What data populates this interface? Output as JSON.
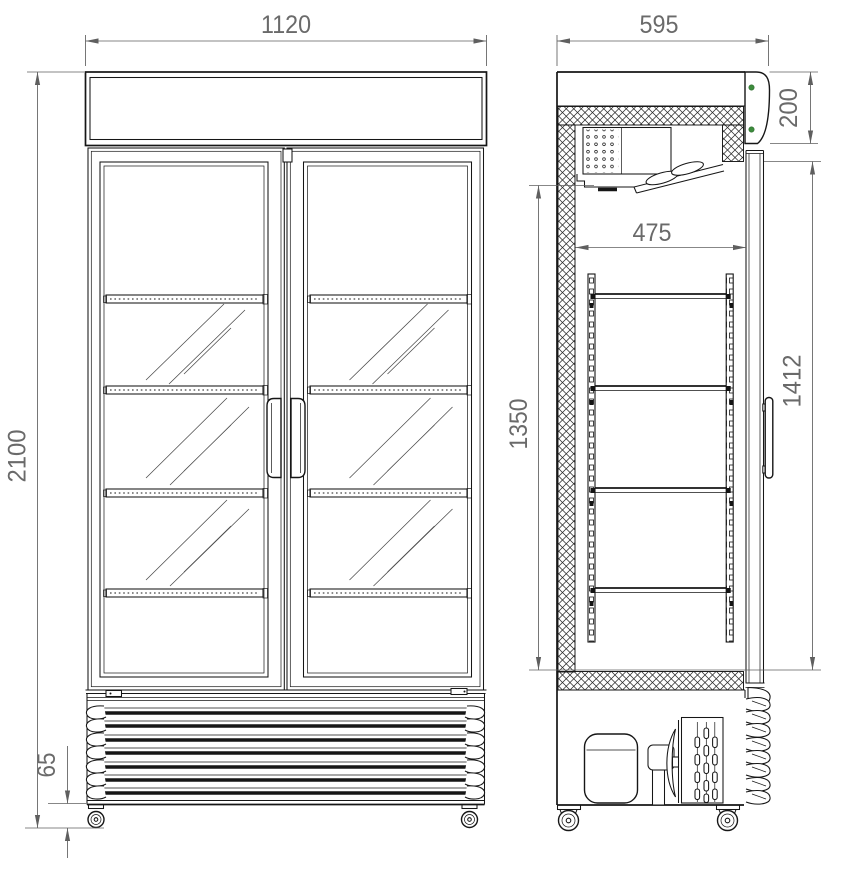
{
  "front_view": {
    "dim_overall_width": "1120",
    "dim_overall_height": "2100",
    "dim_caster_height": "65"
  },
  "side_view": {
    "dim_overall_depth": "595",
    "dim_canopy_height": "200",
    "dim_internal_depth": "475",
    "dim_internal_height": "1350",
    "dim_door_glass_height": "1412"
  },
  "colors": {
    "led_indicator": "#3c8c3c"
  }
}
